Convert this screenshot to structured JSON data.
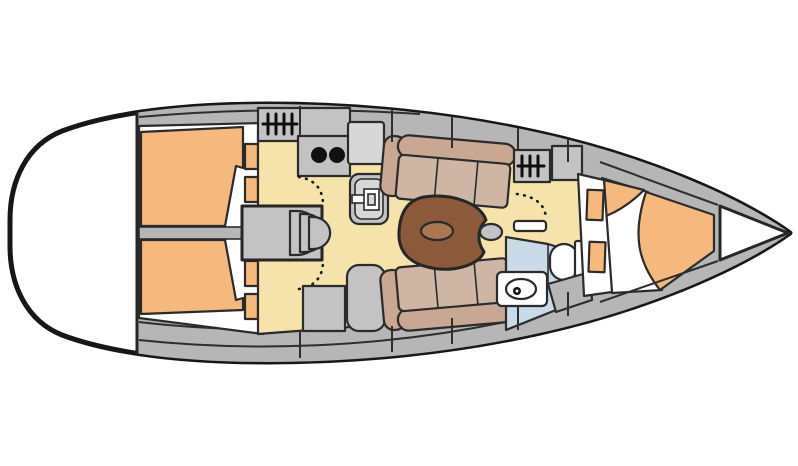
{
  "meta": {
    "title": "Sailboat interior layout — top-down floor plan",
    "orientation": "bow to the right, stern to the left",
    "view": "overhead accommodation plan"
  },
  "colors": {
    "background": "#ffffff",
    "hull_white": "#ffffff",
    "deck": "#b6b6b6",
    "furniture": "#c3c3c3",
    "furniture_light": "#d7d7d7",
    "floor": "#f6e3ab",
    "berth": "#f6b97d",
    "settee_seat": "#cfb5a3",
    "settee_back": "#c8a793",
    "table": "#8a5a3b",
    "table_inlay": "#aa7850",
    "head_floor": "#c9dbe7",
    "white": "#ffffff",
    "black": "#111111"
  },
  "areas": [
    {
      "id": "transom",
      "label": "stern transom platform"
    },
    {
      "id": "aft-cabin-top",
      "label": "aft double cabin (top)"
    },
    {
      "id": "aft-cabin-bottom",
      "label": "aft double cabin (bottom)"
    },
    {
      "id": "companionway",
      "label": "companionway steps over engine box"
    },
    {
      "id": "galley",
      "label": "galley: stove, twin burners, fridge, sink unit"
    },
    {
      "id": "salon",
      "label": "salon with facing settees and table"
    },
    {
      "id": "nav-station",
      "label": "nav desk and seat"
    },
    {
      "id": "head",
      "label": "head with toilet and washbasin"
    },
    {
      "id": "forward-cabin",
      "label": "forward V-berth cabin"
    },
    {
      "id": "anchor-locker",
      "label": "bow anchor locker"
    }
  ],
  "fixtures": {
    "galley_burners": 2,
    "companionway_steps": 3,
    "aft_cabin_shelves": 4,
    "forward_cabin_shelves": 2,
    "door_swings": 3
  }
}
